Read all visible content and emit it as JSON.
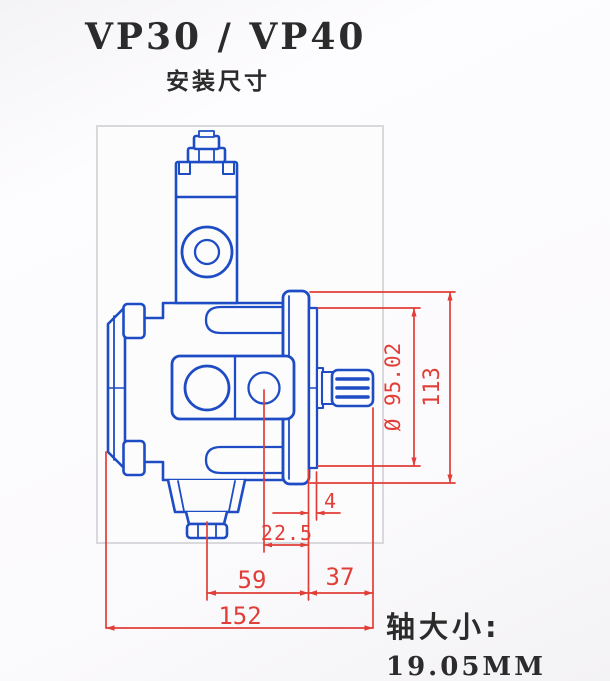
{
  "title": "VP30 / VP40",
  "subtitle": "安装尺寸",
  "shaft_note": {
    "label": "轴大小:",
    "value": "19.05MM"
  },
  "dimensions": {
    "pilot_diameter": "Ø 95.02",
    "flange_height": "113",
    "spigot_depth": "4",
    "port_center_offset": "22.5",
    "center_to_flange": "59",
    "flange_to_shaft_end": "37",
    "overall_length": "152"
  },
  "colors": {
    "drawing_line_blue": "#1d4cc4",
    "dimension_red": "#e23e38",
    "frame_gray": "#d8d8dd",
    "text_black": "#2b2b2b"
  }
}
